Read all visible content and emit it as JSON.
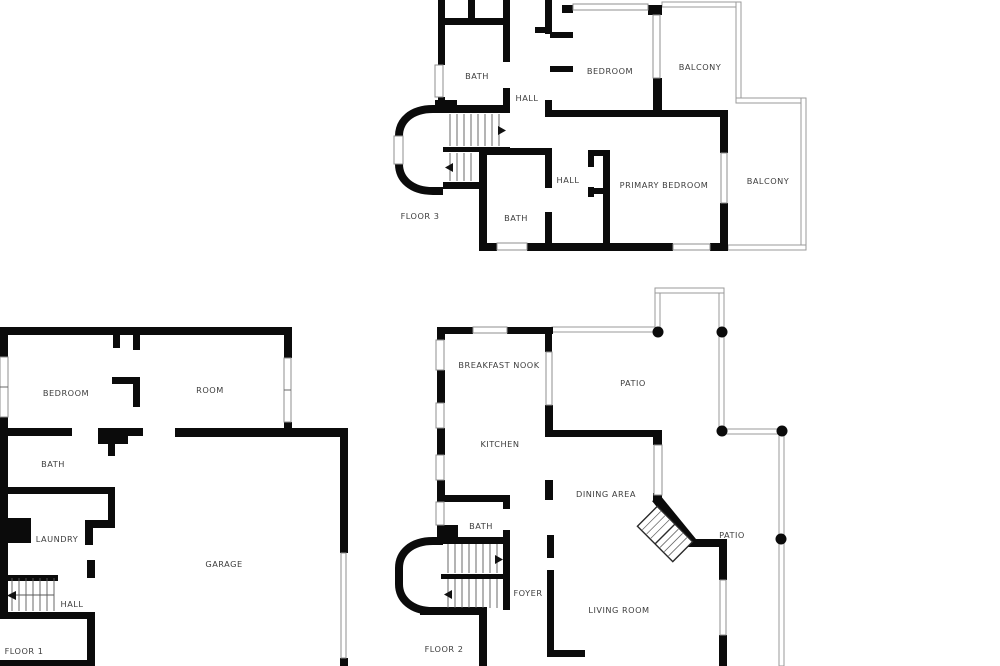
{
  "colors": {
    "wall": "#0b0b0b",
    "window_line": "#8f8f8f",
    "railing_line": "#9a9a9a",
    "stair_line": "#5a5a5a",
    "label_text": "#3d3d3d",
    "background": "#ffffff"
  },
  "floor3": {
    "label": "FLOOR 3",
    "rooms": {
      "bath_upper": "BATH",
      "hall_upper": "HALL",
      "bedroom": "BEDROOM",
      "balcony_upper": "BALCONY",
      "hall_lower": "HALL",
      "primary_bedroom": "PRIMARY BEDROOM",
      "balcony_lower": "BALCONY",
      "bath_lower": "BATH"
    }
  },
  "floor1": {
    "label": "FLOOR 1",
    "rooms": {
      "bedroom": "BEDROOM",
      "room": "ROOM",
      "bath": "BATH",
      "laundry": "LAUNDRY",
      "garage": "GARAGE",
      "hall": "HALL"
    }
  },
  "floor2": {
    "label": "FLOOR 2",
    "rooms": {
      "breakfast_nook": "BREAKFAST NOOK",
      "patio_upper": "PATIO",
      "kitchen": "KITCHEN",
      "dining_area": "DINING AREA",
      "bath": "BATH",
      "foyer": "FOYER",
      "patio_lower": "PATIO",
      "living_room": "LIVING ROOM"
    }
  }
}
